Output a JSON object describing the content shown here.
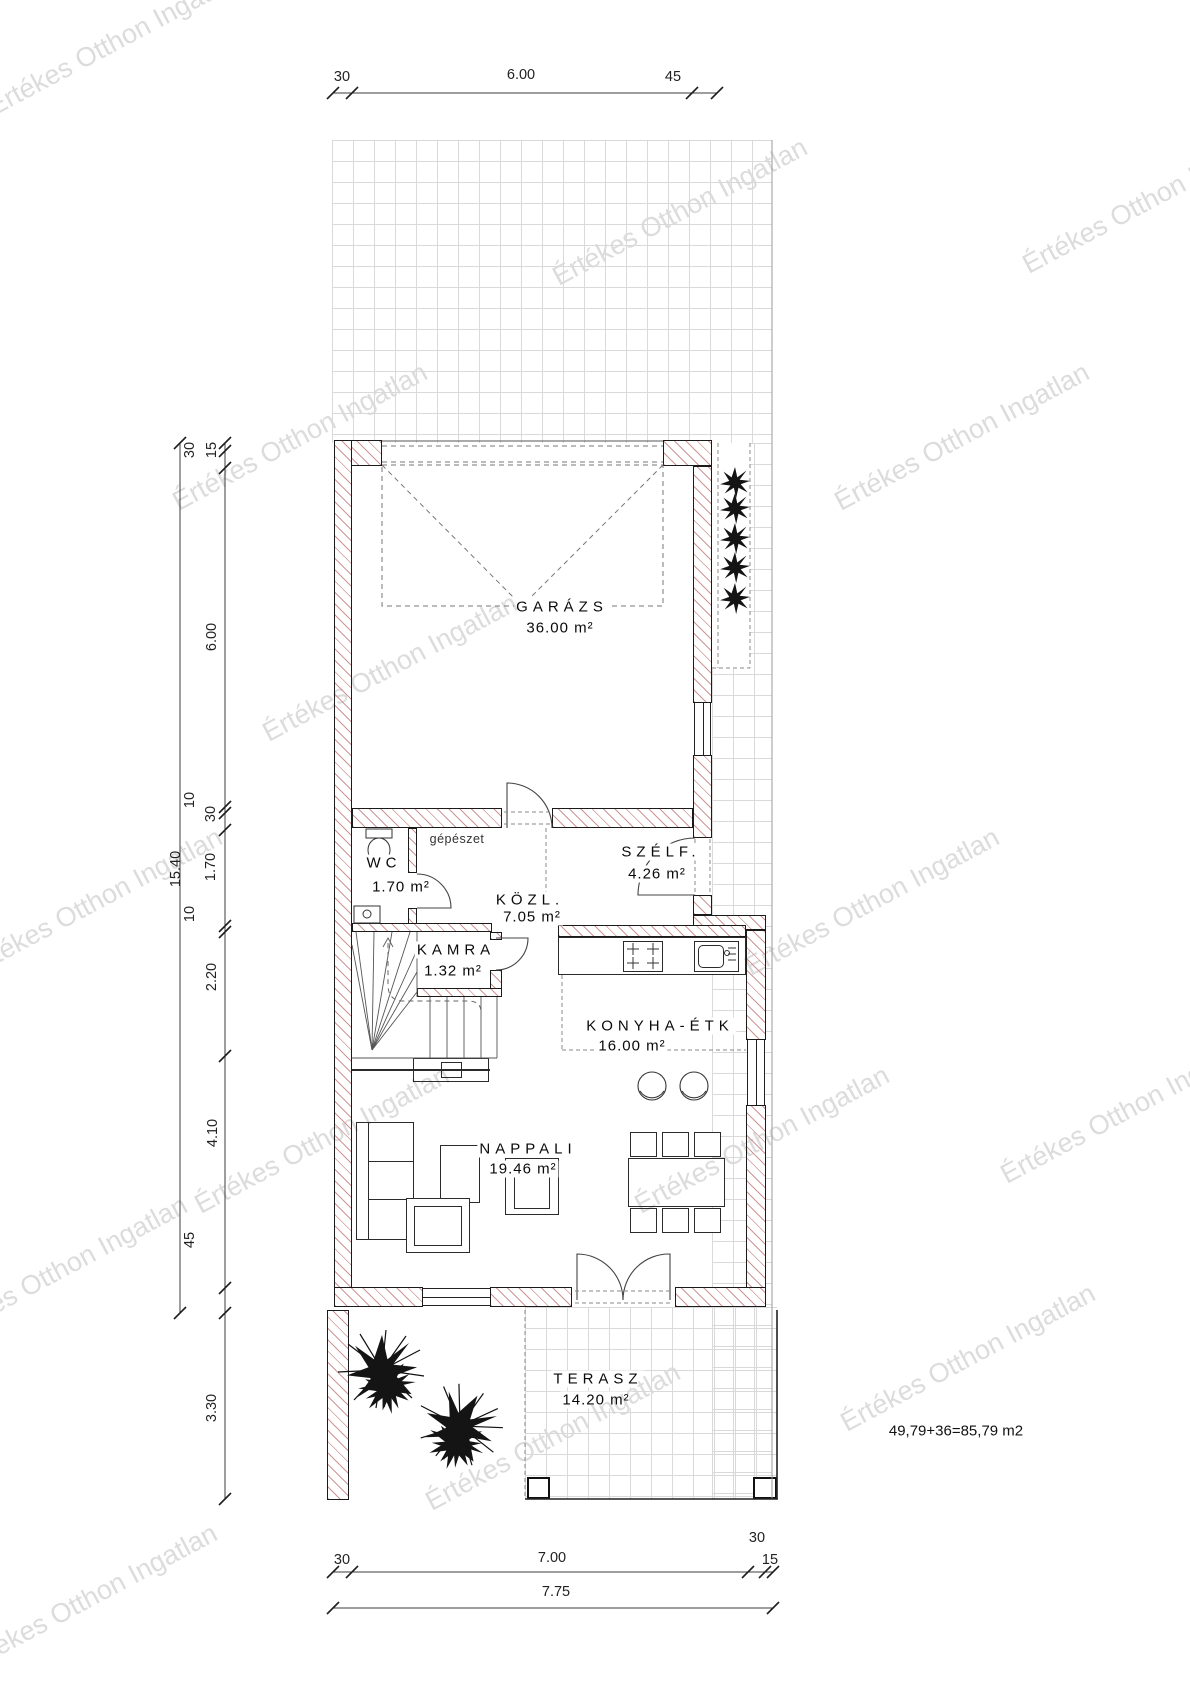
{
  "watermark": {
    "text": "Értékes Otthon Ingatlan"
  },
  "notes": {
    "gepeszet": "gépészet",
    "area_sum": "49,79+36=85,79 m2"
  },
  "rooms": {
    "garazs": {
      "name": "GARÁZS",
      "area": "36.00 m²"
    },
    "wc": {
      "name": "WC",
      "area": "1.70 m²"
    },
    "szelfogo": {
      "name": "SZÉLF.",
      "area": "4.26 m²"
    },
    "kozlekedo": {
      "name": "KÖZL.",
      "area": "7.05 m²"
    },
    "kamra": {
      "name": "KAMRA",
      "area": "1.32 m²"
    },
    "konyha_etkezo": {
      "name": "KONYHA-ÉTK",
      "area": "16.00 m²"
    },
    "nappali": {
      "name": "NAPPALI",
      "area": "19.46 m²"
    },
    "terasz": {
      "name": "TERASZ",
      "area": "14.20 m²"
    }
  },
  "dimensions": {
    "top": [
      "30",
      "6.00",
      "45"
    ],
    "left_total": "15.40",
    "left": [
      "30",
      "15",
      "6.00",
      "10",
      "30",
      "1.70",
      "10",
      "2.20",
      "4.10",
      "45",
      "3.30"
    ],
    "bottom": [
      "30",
      "7.00",
      "30",
      "15"
    ],
    "bottom_total": "7.75"
  }
}
